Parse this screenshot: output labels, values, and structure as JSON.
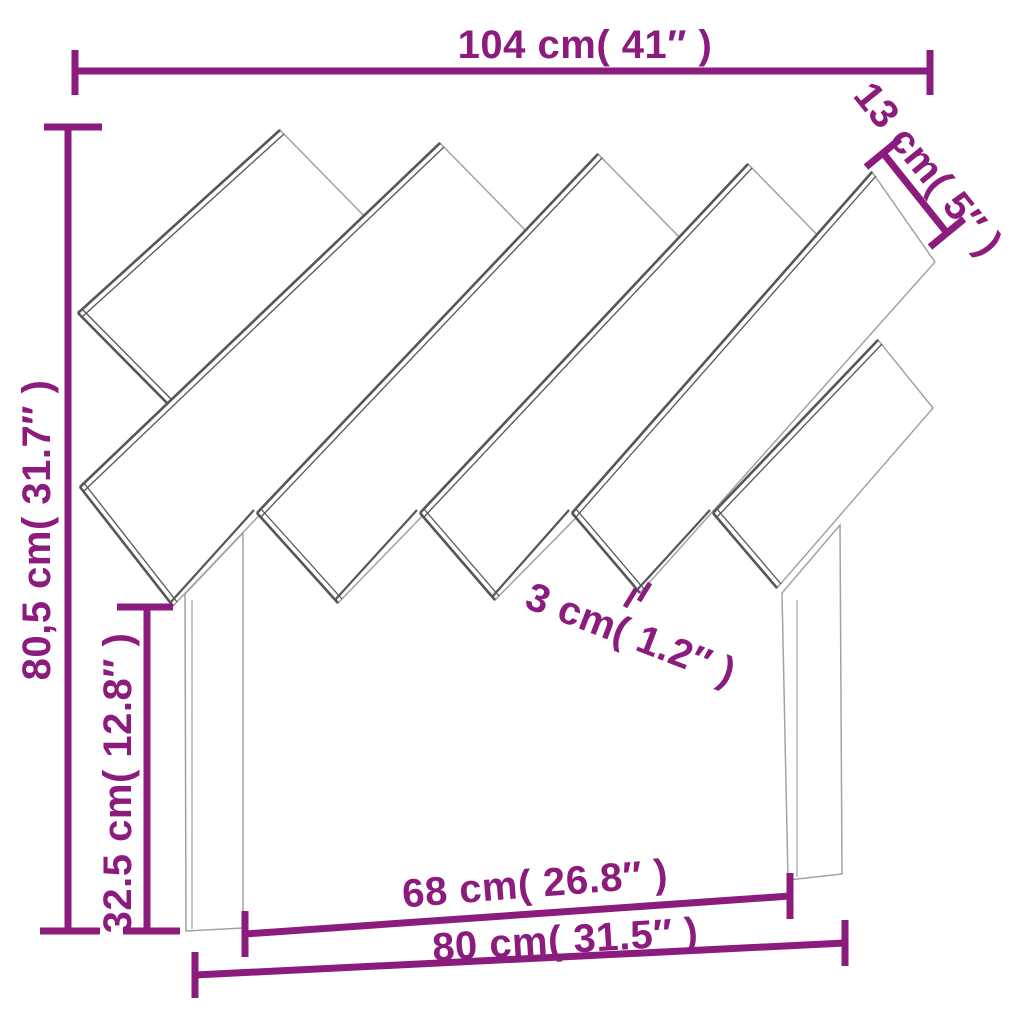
{
  "page": {
    "background": "#ffffff"
  },
  "colors": {
    "dimension": "#8b1b7d",
    "edge_light": "#a2a2a2",
    "edge_dark": "#565656"
  },
  "diagram": {
    "type": "product-dimension-diagram",
    "subject": "headboard with six diagonal slats and two legs",
    "dimensions": {
      "total_width": {
        "label": "104 cm( 41″ )",
        "cm": "104",
        "inch": "41″"
      },
      "slat_width": {
        "label": "13 cm( 5″ )",
        "cm": "13",
        "inch": "5″"
      },
      "total_height": {
        "label": "80,5 cm( 31.7″ )",
        "cm": "80,5",
        "inch": "31.7″"
      },
      "leg_height": {
        "label": "32.5 cm( 12.8″ )",
        "cm": "32.5",
        "inch": "12.8″"
      },
      "slat_gap": {
        "label": "3 cm( 1.2″ )",
        "cm": "3",
        "inch": "1.2″"
      },
      "inner_span": {
        "label": "68 cm( 26.8″ )",
        "cm": "68",
        "inch": "26.8″"
      },
      "outer_span": {
        "label": "80 cm( 31.5″ )",
        "cm": "80",
        "inch": "31.5″"
      }
    }
  }
}
